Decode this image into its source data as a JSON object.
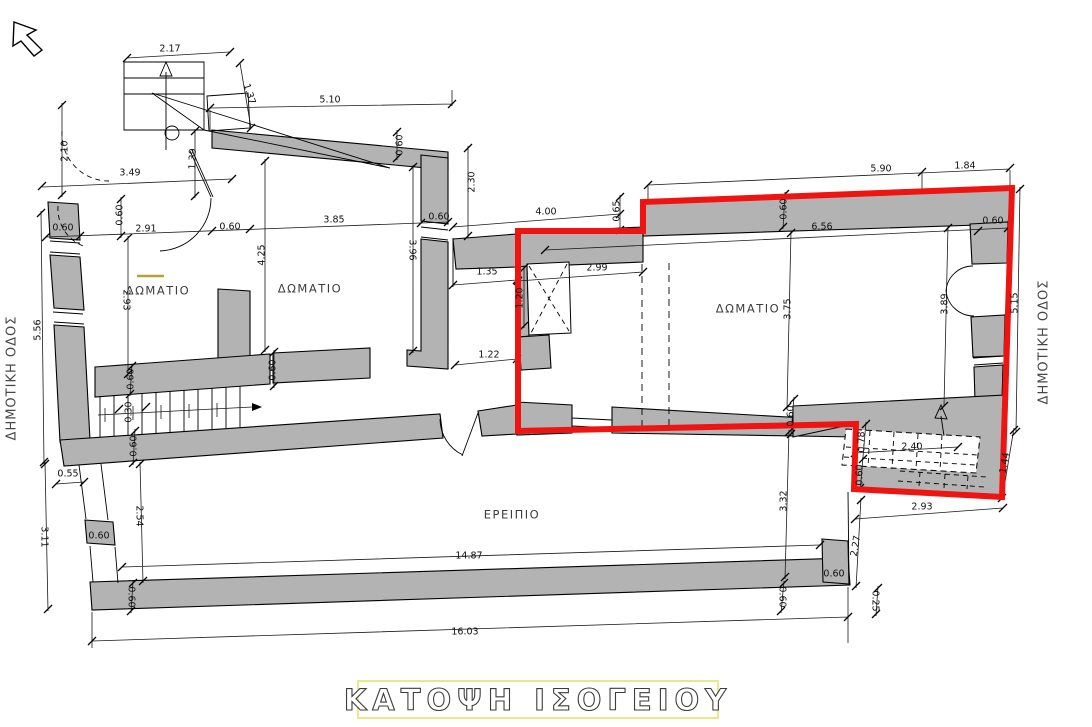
{
  "title": {
    "text": "ΚΑΤΟΨΗ ΙΣΟΓΕΙΟΥ"
  },
  "streets": {
    "left": "ΔΗΜΟΤΙΚΗ ΟΔΟΣ",
    "right": "ΔΗΜΟΤΙΚΗ ΟΔΟΣ"
  },
  "rooms": [
    {
      "label": "ΔΩΜΑΤΙΟ"
    },
    {
      "label": "ΔΩΜΑΤΙΟ"
    },
    {
      "label": "ΔΩΜΑΤΙΟ"
    },
    {
      "label": "ΕΡΕΙΠΙΟ"
    }
  ],
  "dims": [
    "2.17",
    "1.37",
    "5.10",
    "0.60",
    "2.30",
    "2.10",
    "3.49",
    "1.39",
    "0.60",
    "2.91",
    "0.60",
    "0.60",
    "3.85",
    "0.60",
    "4.25",
    "3.96",
    "2.93",
    "0.60",
    "0.60",
    "0.30",
    "0.60",
    "5.56",
    "0.55",
    "3.11",
    "2.54",
    "0.60",
    "0.60",
    "14.87",
    "16.03",
    "0.60",
    "3.32",
    "0.60",
    "2.27",
    "0.25",
    "0.60",
    "2.93",
    "1.44",
    "2.40",
    "0.78",
    "0.60",
    "4.00",
    "0.65",
    "5.90",
    "1.84",
    "0.60",
    "0.60",
    "6.56",
    "2.99",
    "1.35",
    "1.20",
    "1.22",
    "3.75",
    "3.89",
    "5.15"
  ],
  "colors": {
    "wall_gray": "#b3b3b3",
    "selection_outline_red": "#ee1411",
    "title_border_yellow": "#e9e98a",
    "marker_yellow": "#b5a433",
    "line_black": "#000000",
    "background": "#ffffff"
  },
  "icons": {
    "north_arrow": "north-arrow"
  }
}
